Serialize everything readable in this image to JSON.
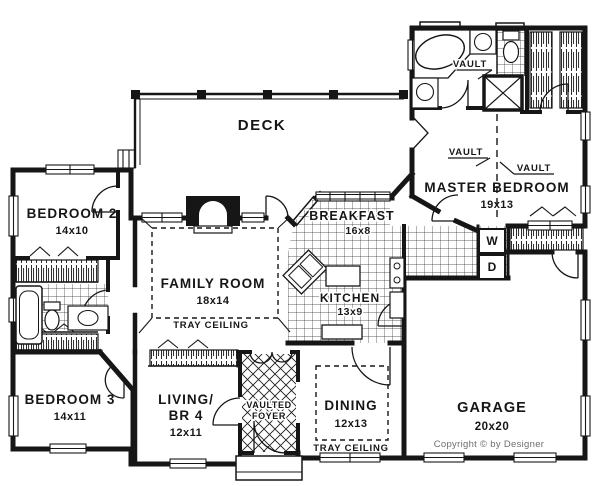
{
  "rooms": {
    "deck": {
      "label": "DECK"
    },
    "bedroom2": {
      "label": "BEDROOM 2",
      "dims": "14x10"
    },
    "family_room": {
      "label": "FAMILY ROOM",
      "dims": "18x14",
      "ceiling": "TRAY CEILING"
    },
    "breakfast": {
      "label": "BREAKFAST",
      "dims": "16x8"
    },
    "kitchen": {
      "label": "KITCHEN",
      "dims": "13x9"
    },
    "master_bedroom": {
      "label": "MASTER BEDROOM",
      "dims": "19x13",
      "vault_left": "VAULT",
      "vault_right": "VAULT"
    },
    "master_bath": {
      "vault": "VAULT"
    },
    "bedroom3": {
      "label": "BEDROOM 3",
      "dims": "14x11"
    },
    "living_br4": {
      "line1": "LIVING/",
      "line2": "BR 4",
      "dims": "12x11"
    },
    "foyer": {
      "line1": "VAULTED",
      "line2": "FOYER"
    },
    "dining": {
      "label": "DINING",
      "dims": "12x13",
      "ceiling": "TRAY CEILING"
    },
    "garage": {
      "label": "GARAGE",
      "dims": "20x20"
    }
  },
  "appliances": {
    "washer": "W",
    "dryer": "D"
  },
  "copyright": "Copyright © by Designer",
  "colors": {
    "ink": "#161616",
    "paper": "#ffffff",
    "muted": "#6e6e6e"
  }
}
